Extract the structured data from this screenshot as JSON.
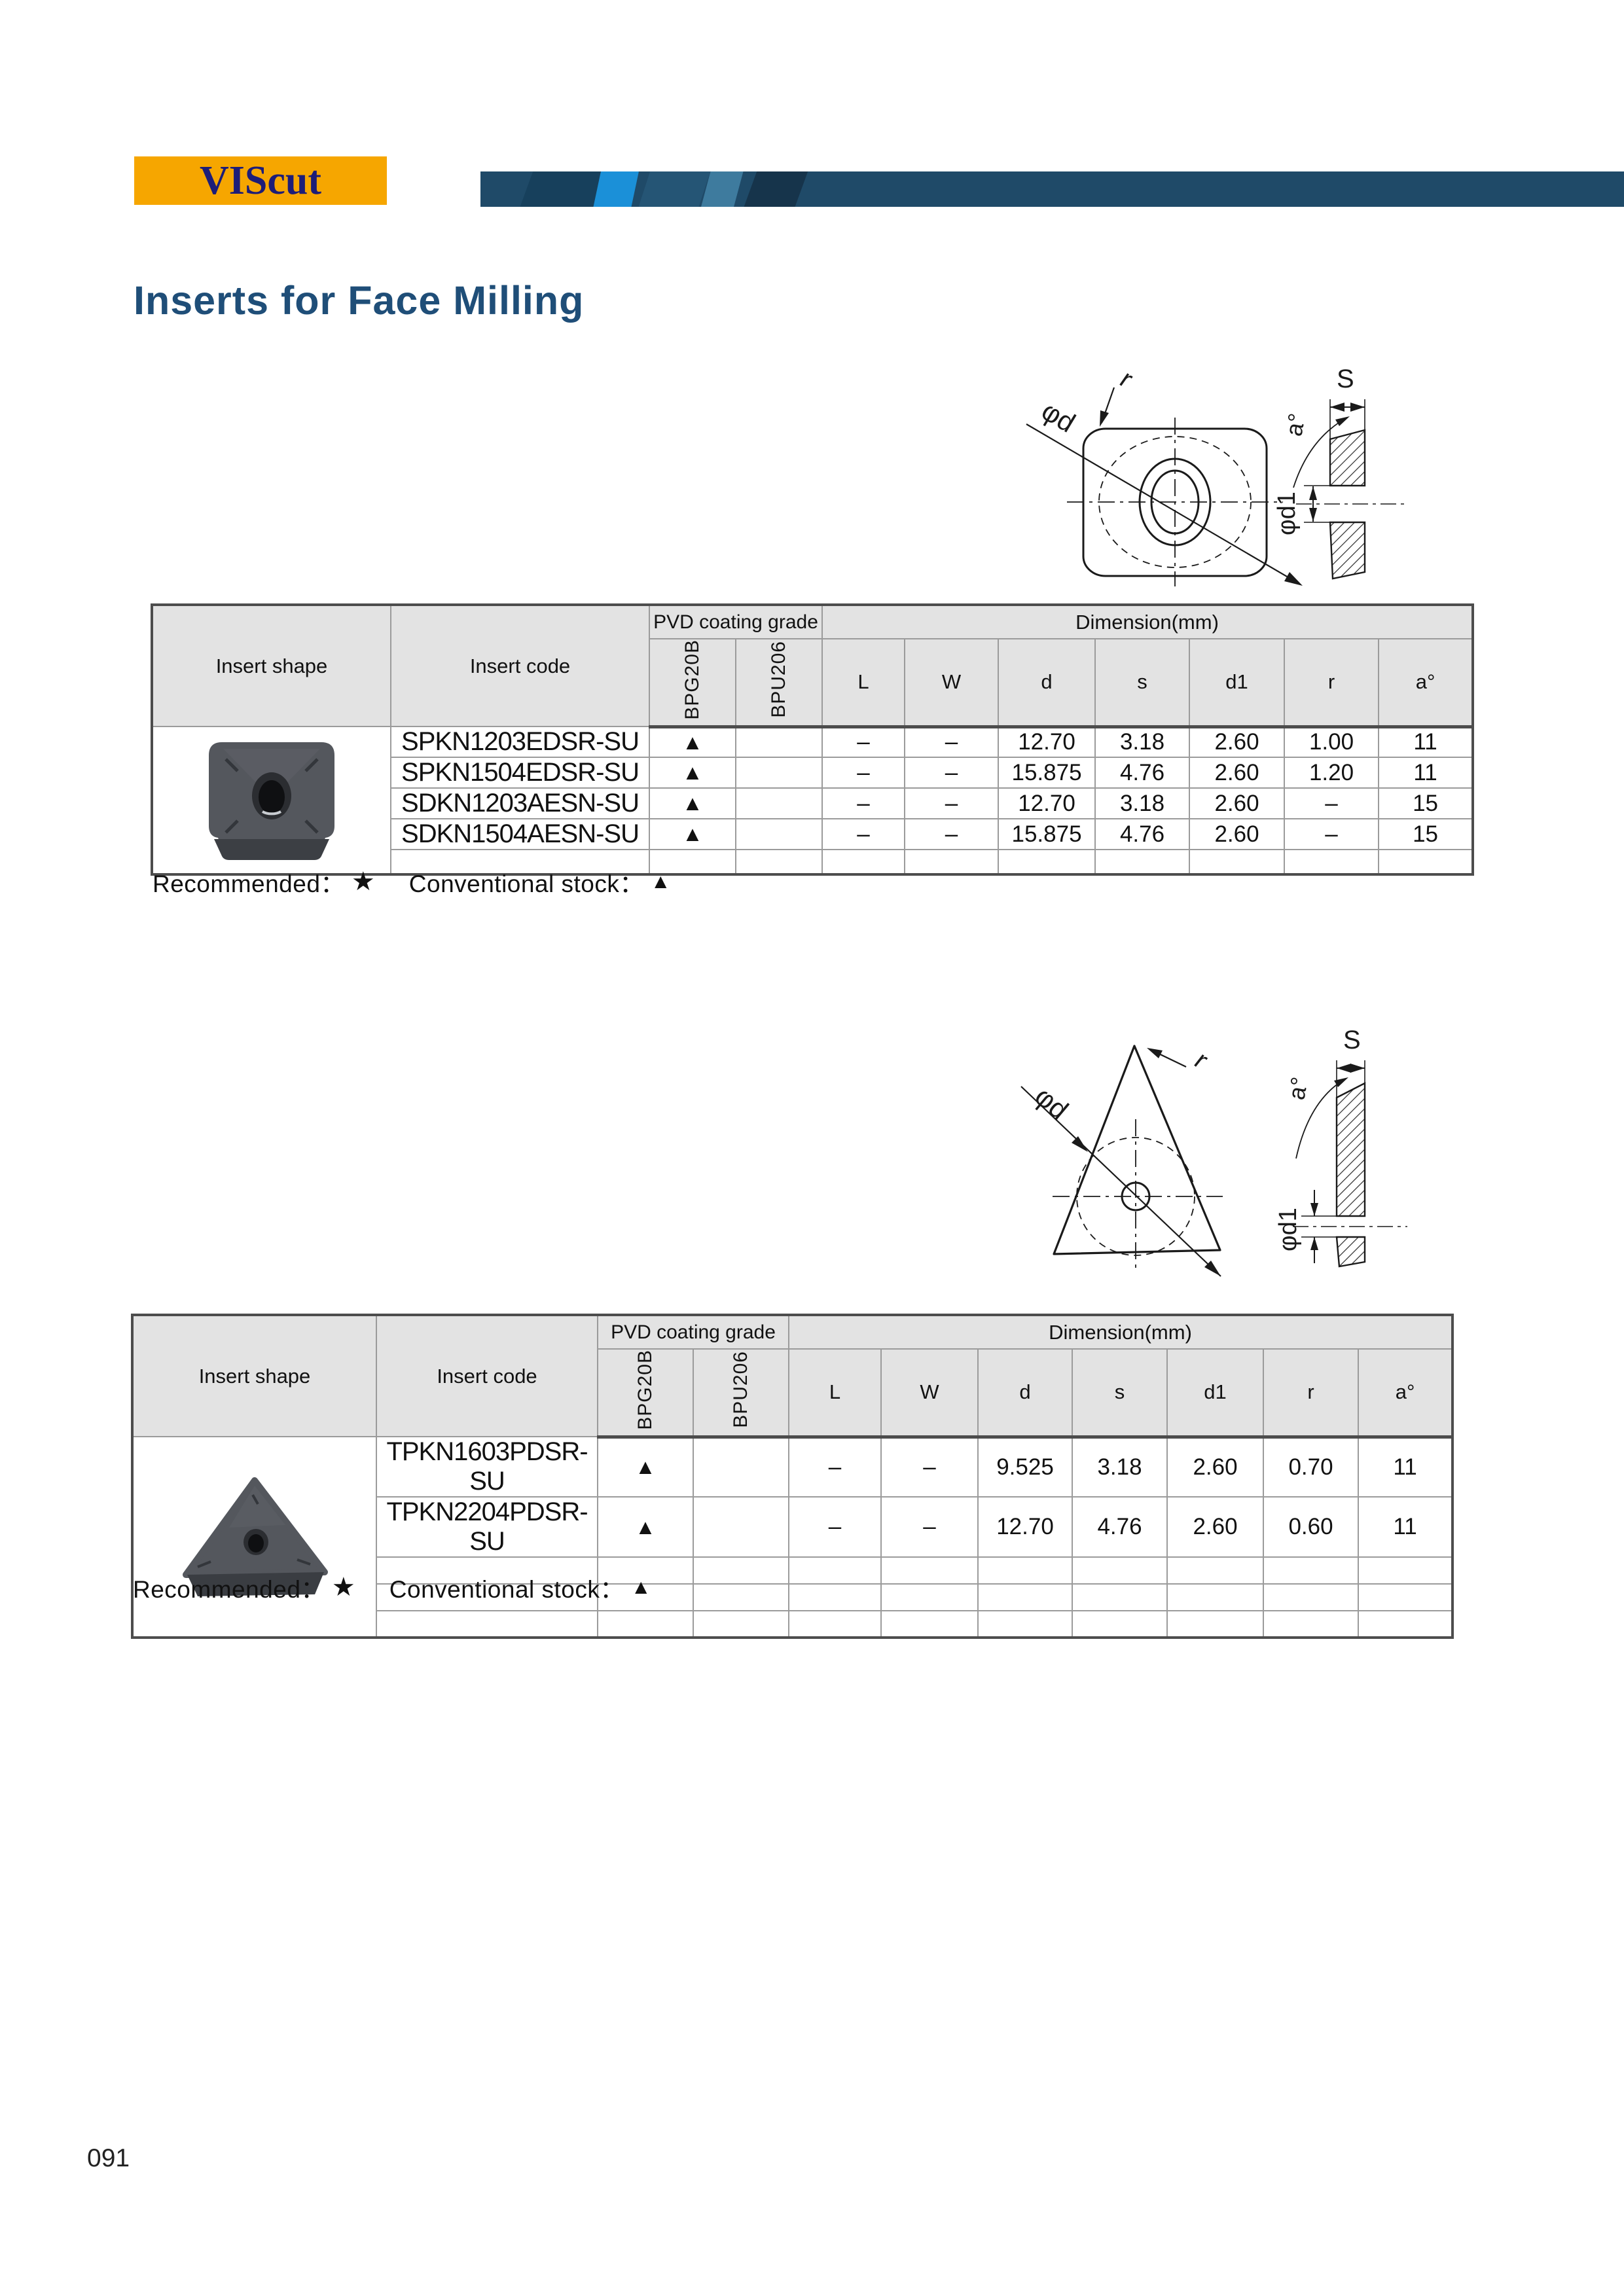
{
  "page": {
    "logo": "VIScut",
    "title": "Inserts for Face Milling",
    "number": "091"
  },
  "colors": {
    "logo_bg": "#F6A600",
    "logo_text": "#1D1D78",
    "bar_blue": "#1F4A68",
    "bar_accent": "#1B90D8",
    "title_blue": "#1F4E78",
    "header_cell_gray": "#E3E3E3"
  },
  "legend": {
    "recommended": "Recommended：",
    "star": "★",
    "stock": "Conventional stock：",
    "triangle": "▲"
  },
  "diagram_labels": {
    "diameter": "φd",
    "radius": "r",
    "thickness": "S",
    "angle": "a°",
    "hole": "φd1"
  },
  "table_headers": {
    "shape": "Insert shape",
    "code": "Insert code",
    "pvd": "PVD coating grade",
    "grades": [
      "BPG20B",
      "BPU206"
    ],
    "dimension": "Dimension(mm)",
    "dims": [
      "L",
      "W",
      "d",
      "s",
      "d1",
      "r",
      "a°"
    ]
  },
  "tables": [
    {
      "name": "square-inserts",
      "rows": [
        {
          "code": "SPKN1203EDSR-SU",
          "bpg20b": "▲",
          "bpu206": "",
          "L": "–",
          "W": "–",
          "d": "12.70",
          "s": "3.18",
          "d1": "2.60",
          "r": "1.00",
          "a": "11"
        },
        {
          "code": "SPKN1504EDSR-SU",
          "bpg20b": "▲",
          "bpu206": "",
          "L": "–",
          "W": "–",
          "d": "15.875",
          "s": "4.76",
          "d1": "2.60",
          "r": "1.20",
          "a": "11"
        },
        {
          "code": "SDKN1203AESN-SU",
          "bpg20b": "▲",
          "bpu206": "",
          "L": "–",
          "W": "–",
          "d": "12.70",
          "s": "3.18",
          "d1": "2.60",
          "r": "–",
          "a": "15"
        },
        {
          "code": "SDKN1504AESN-SU",
          "bpg20b": "▲",
          "bpu206": "",
          "L": "–",
          "W": "–",
          "d": "15.875",
          "s": "4.76",
          "d1": "2.60",
          "r": "–",
          "a": "15"
        }
      ]
    },
    {
      "name": "triangle-inserts",
      "rows": [
        {
          "code": "TPKN1603PDSR-SU",
          "bpg20b": "▲",
          "bpu206": "",
          "L": "–",
          "W": "–",
          "d": "9.525",
          "s": "3.18",
          "d1": "2.60",
          "r": "0.70",
          "a": "11"
        },
        {
          "code": "TPKN2204PDSR-SU",
          "bpg20b": "▲",
          "bpu206": "",
          "L": "–",
          "W": "–",
          "d": "12.70",
          "s": "4.76",
          "d1": "2.60",
          "r": "0.60",
          "a": "11"
        }
      ]
    }
  ]
}
